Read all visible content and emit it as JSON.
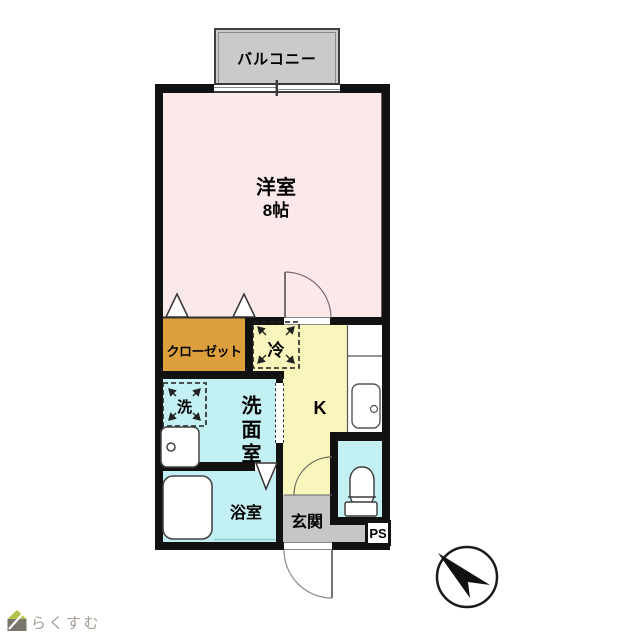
{
  "labels": {
    "balcony": "バルコニー",
    "main_room_name": "洋室",
    "main_room_size": "8帖",
    "closet": "クローゼット",
    "fridge": "冷",
    "kitchen": "K",
    "washer": "洗",
    "washroom": "洗面室",
    "bathroom": "浴室",
    "entrance": "玄関",
    "pipe_space": "PS"
  },
  "logo": {
    "text": "らくすむ"
  },
  "colors": {
    "main_room_pink": "#fbe9e9",
    "closet_orange": "#dc9f3b",
    "kitchen_yellow": "#f8f6bd",
    "wet_area_cyan": "#c3f0f2",
    "balcony_gray": "#cacaca",
    "entrance_gray": "#c6c6c6",
    "wall_black": "#111111",
    "logo_roof_green": "#b6c24b",
    "logo_body_gray": "#7a746c",
    "logo_text_gray": "#a39b92"
  }
}
